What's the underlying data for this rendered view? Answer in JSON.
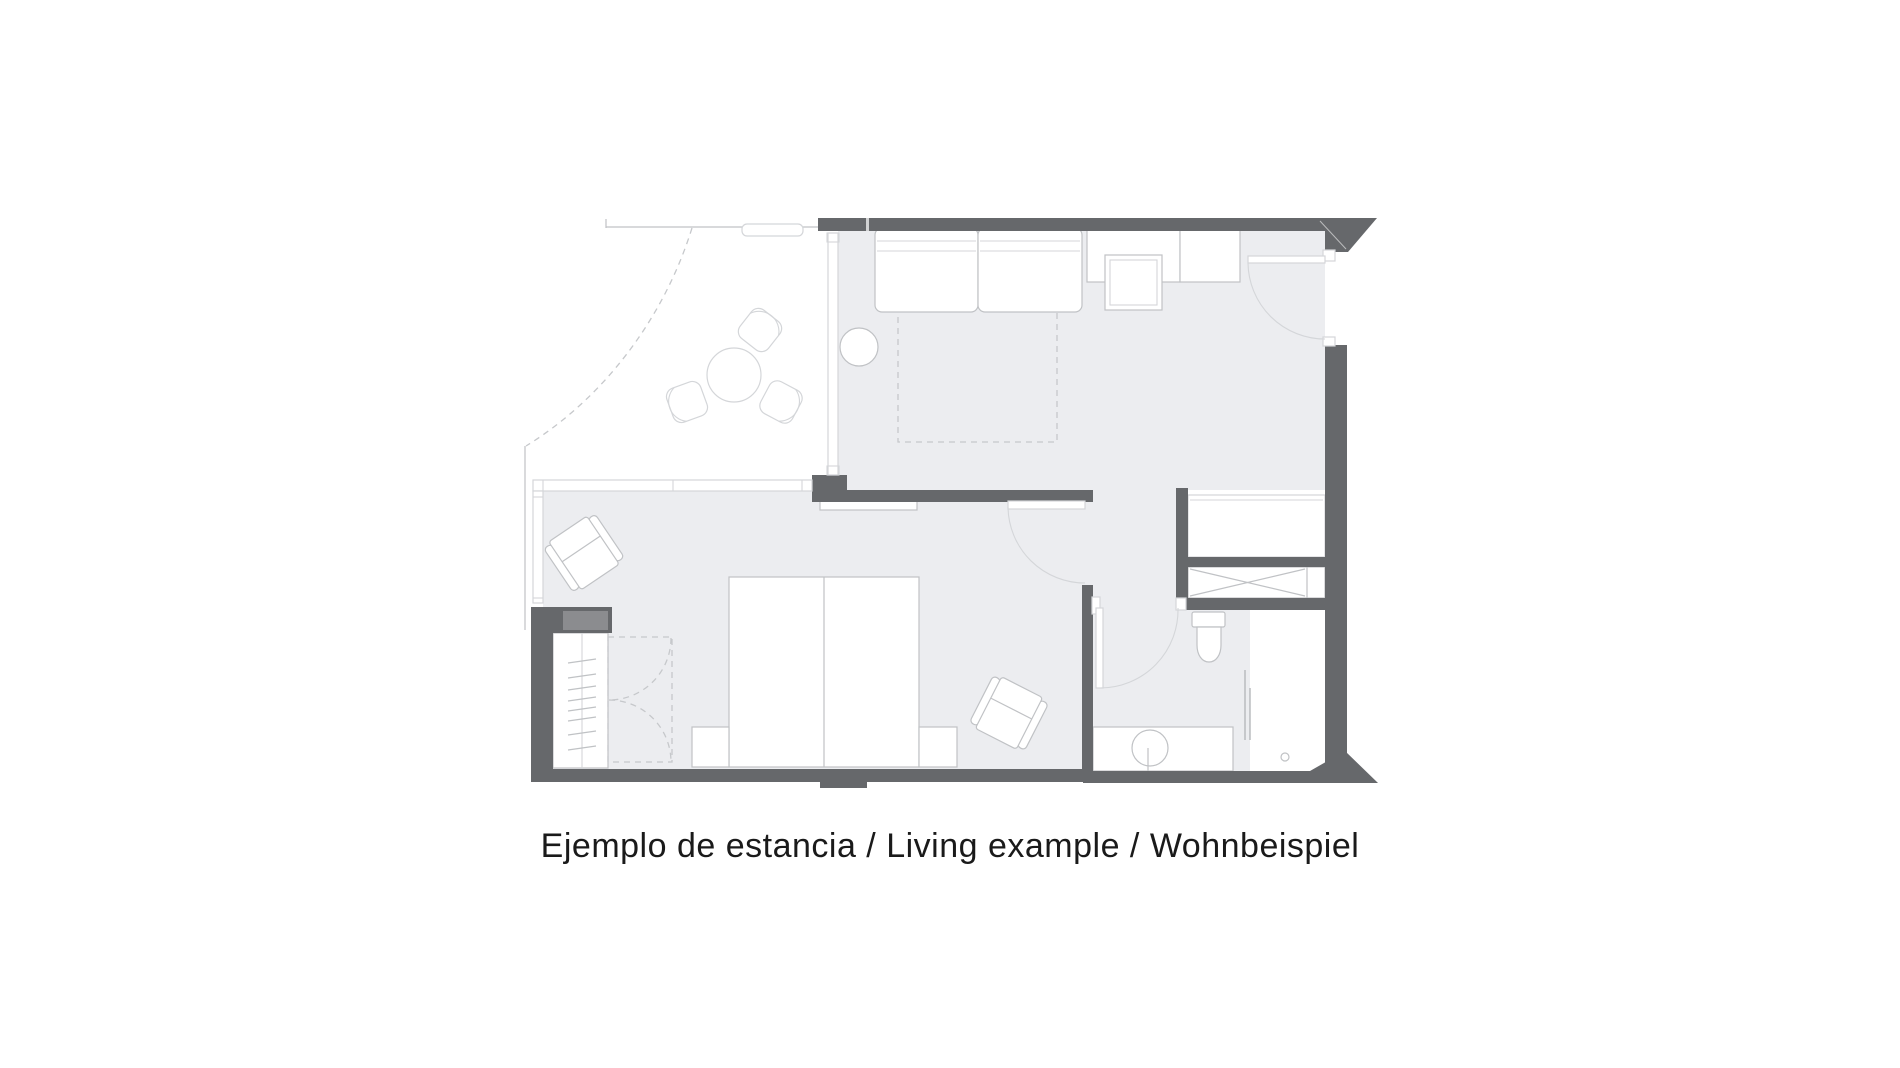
{
  "caption": {
    "text": "Ejemplo de estancia / Living example / Wohnbeispiel"
  },
  "colors": {
    "background": "#FFFFFF",
    "floor": "#ECEDF0",
    "wall": "#66686B",
    "wall-light": "#8B8C8F",
    "line": "#C0C2C5",
    "line-light": "#D4D6D9",
    "dash": "#C6C8CB",
    "glass": "#B6B8BB",
    "text": "#1A1A1A"
  }
}
